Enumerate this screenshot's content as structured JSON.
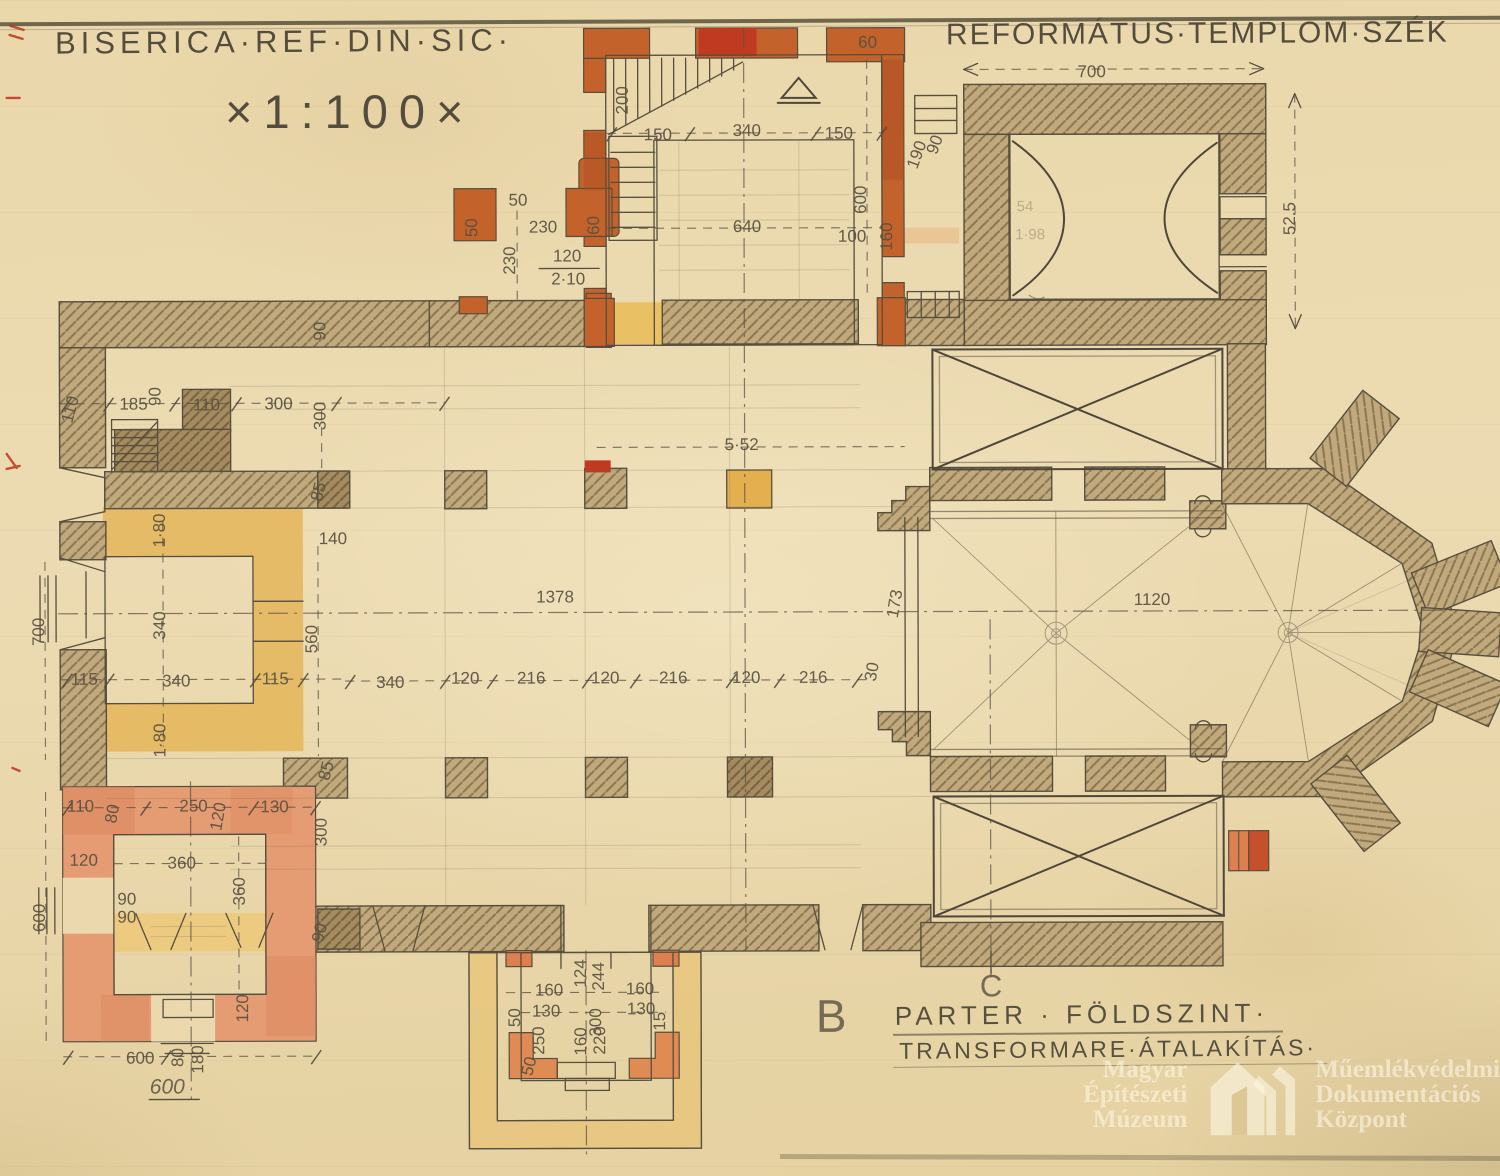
{
  "titles": {
    "left": "BISERICA·REF·DIN·SIC·",
    "scale": "×1:100×",
    "right": "REFORMÁTUS·TEMPLOM·SZÉK"
  },
  "captions": {
    "line1": "PARTER  ·  FÖLDSZINT·",
    "line2": "TRANSFORMARE·ÁTALAKÍTÁS·"
  },
  "watermark": {
    "left": [
      "Magyar",
      "Építészeti",
      "Múzeum"
    ],
    "right": [
      "Műemlékvédelmi",
      "Dokumentációs",
      "Központ"
    ],
    "logo": "house-door-icon"
  },
  "colors": {
    "paper": "#ebd9ad",
    "pencil": "#564f3f",
    "wall_existing": "#c0a97c",
    "wall_existing_dark": "#a58c60",
    "wall_new_orange": "#c4622c",
    "wall_new_red": "#bf3a20",
    "wall_new_salmon": "#e59c73",
    "wash_yellow": "#e4b65c",
    "wash_yellow_light": "#e8c77f",
    "red_archive_mark": "#bf331d"
  },
  "plan": {
    "dimensions": [
      {
        "t": "60",
        "x": 869,
        "y": 48
      },
      {
        "t": "150",
        "x": 659,
        "y": 140
      },
      {
        "t": "340",
        "x": 748,
        "y": 136
      },
      {
        "t": "150",
        "x": 840,
        "y": 139
      },
      {
        "t": "640",
        "x": 748,
        "y": 232
      },
      {
        "t": "600",
        "x": 867,
        "y": 200,
        "r": -90
      },
      {
        "t": "100",
        "x": 853,
        "y": 242
      },
      {
        "t": "160",
        "x": 893,
        "y": 237,
        "r": -90
      },
      {
        "t": "190",
        "x": 923,
        "y": 157,
        "r": -70
      },
      {
        "t": "90",
        "x": 941,
        "y": 147,
        "r": -70
      },
      {
        "t": "200",
        "x": 629,
        "y": 100,
        "r": -90
      },
      {
        "t": "50",
        "x": 478,
        "y": 227,
        "r": -90
      },
      {
        "t": "50",
        "x": 519,
        "y": 205
      },
      {
        "t": "230",
        "x": 544,
        "y": 232
      },
      {
        "t": "230",
        "x": 516,
        "y": 260,
        "r": -90
      },
      {
        "t": "60",
        "x": 600,
        "y": 225,
        "r": -90
      },
      {
        "t": "120",
        "x": 568,
        "y": 261
      },
      {
        "t": "2·10",
        "x": 569,
        "y": 284
      },
      {
        "t": "90",
        "x": 326,
        "y": 330,
        "r": -90
      },
      {
        "t": "700",
        "x": 1093,
        "y": 78
      },
      {
        "t": "52.5",
        "x": 1296,
        "y": 220,
        "r": -90
      },
      {
        "t": "54",
        "x": 1026,
        "y": 212,
        "cls": "faint"
      },
      {
        "t": "1·98",
        "x": 1031,
        "y": 240,
        "cls": "faint"
      },
      {
        "t": "110",
        "x": 76,
        "y": 409,
        "r": -75
      },
      {
        "t": "185",
        "x": 134,
        "y": 408
      },
      {
        "t": "90",
        "x": 161,
        "y": 395,
        "r": -90
      },
      {
        "t": "110",
        "x": 207,
        "y": 409
      },
      {
        "t": "300",
        "x": 279,
        "y": 408
      },
      {
        "t": "300",
        "x": 326,
        "y": 415,
        "r": -90
      },
      {
        "t": "85",
        "x": 324,
        "y": 492,
        "r": -75
      },
      {
        "t": "140",
        "x": 333,
        "y": 543
      },
      {
        "t": "560",
        "x": 317,
        "y": 638,
        "r": -90
      },
      {
        "t": "1·80",
        "x": 165,
        "y": 529,
        "r": -90
      },
      {
        "t": "340",
        "x": 165,
        "y": 624,
        "r": -90
      },
      {
        "t": "115",
        "x": 84,
        "y": 683
      },
      {
        "t": "340",
        "x": 176,
        "y": 685
      },
      {
        "t": "115",
        "x": 275,
        "y": 683
      },
      {
        "t": "1·80",
        "x": 165,
        "y": 739,
        "r": -90
      },
      {
        "t": "700",
        "x": 44,
        "y": 630,
        "r": -90
      },
      {
        "t": "85",
        "x": 331,
        "y": 771,
        "r": -75
      },
      {
        "t": "5·52",
        "x": 742,
        "y": 450
      },
      {
        "t": "1378",
        "x": 555,
        "y": 602
      },
      {
        "t": "340",
        "x": 390,
        "y": 687
      },
      {
        "t": "120",
        "x": 465,
        "y": 683
      },
      {
        "t": "216",
        "x": 531,
        "y": 683
      },
      {
        "t": "120",
        "x": 605,
        "y": 683
      },
      {
        "t": "216",
        "x": 673,
        "y": 683
      },
      {
        "t": "120",
        "x": 746,
        "y": 683
      },
      {
        "t": "216",
        "x": 813,
        "y": 683
      },
      {
        "t": "30",
        "x": 877,
        "y": 673,
        "r": -80
      },
      {
        "t": "173",
        "x": 900,
        "y": 605,
        "r": -80
      },
      {
        "t": "1120",
        "x": 1152,
        "y": 606
      },
      {
        "t": "110",
        "x": 80,
        "y": 810
      },
      {
        "t": "80",
        "x": 117,
        "y": 813,
        "r": -80
      },
      {
        "t": "250",
        "x": 193,
        "y": 810
      },
      {
        "t": "120",
        "x": 223,
        "y": 816,
        "r": -80
      },
      {
        "t": "130",
        "x": 274,
        "y": 811
      },
      {
        "t": "300",
        "x": 326,
        "y": 831,
        "r": -90
      },
      {
        "t": "120",
        "x": 83,
        "y": 864
      },
      {
        "t": "360",
        "x": 181,
        "y": 867
      },
      {
        "t": "360",
        "x": 244,
        "y": 890,
        "r": -90
      },
      {
        "t": "90",
        "x": 126,
        "y": 903
      },
      {
        "t": "90",
        "x": 126,
        "y": 921
      },
      {
        "t": "600",
        "x": 44,
        "y": 916,
        "r": -90
      },
      {
        "t": "90",
        "x": 324,
        "y": 933,
        "r": -75
      },
      {
        "t": "120",
        "x": 247,
        "y": 1007,
        "r": -90
      },
      {
        "t": "600",
        "x": 139,
        "y": 1062
      },
      {
        "t": "80",
        "x": 182,
        "y": 1056,
        "r": -90
      },
      {
        "t": "180",
        "x": 202,
        "y": 1058,
        "r": -90
      },
      {
        "t": "600",
        "x": 166,
        "y": 1092,
        "cls": "cursive"
      },
      {
        "t": "124",
        "x": 585,
        "y": 973,
        "r": -90
      },
      {
        "t": "244",
        "x": 603,
        "y": 976,
        "r": -90
      },
      {
        "t": "160",
        "x": 548,
        "y": 995
      },
      {
        "t": "160",
        "x": 639,
        "y": 994
      },
      {
        "t": "50",
        "x": 519,
        "y": 1017,
        "r": -90
      },
      {
        "t": "130",
        "x": 545,
        "y": 1016
      },
      {
        "t": "130",
        "x": 640,
        "y": 1014
      },
      {
        "t": "15",
        "x": 664,
        "y": 1021,
        "r": -90
      },
      {
        "t": "300",
        "x": 600,
        "y": 1022,
        "r": -90
      },
      {
        "t": "250",
        "x": 543,
        "y": 1040,
        "r": -90
      },
      {
        "t": "160",
        "x": 585,
        "y": 1041,
        "r": -90
      },
      {
        "t": "220",
        "x": 604,
        "y": 1040,
        "r": -90
      },
      {
        "t": "50",
        "x": 533,
        "y": 1067,
        "r": -75
      },
      {
        "t": "B",
        "x": 830,
        "y": 1032,
        "cls": "marker",
        "s": 46
      },
      {
        "t": "C",
        "x": 990,
        "y": 997,
        "cls": "marker",
        "s": 31
      }
    ]
  }
}
